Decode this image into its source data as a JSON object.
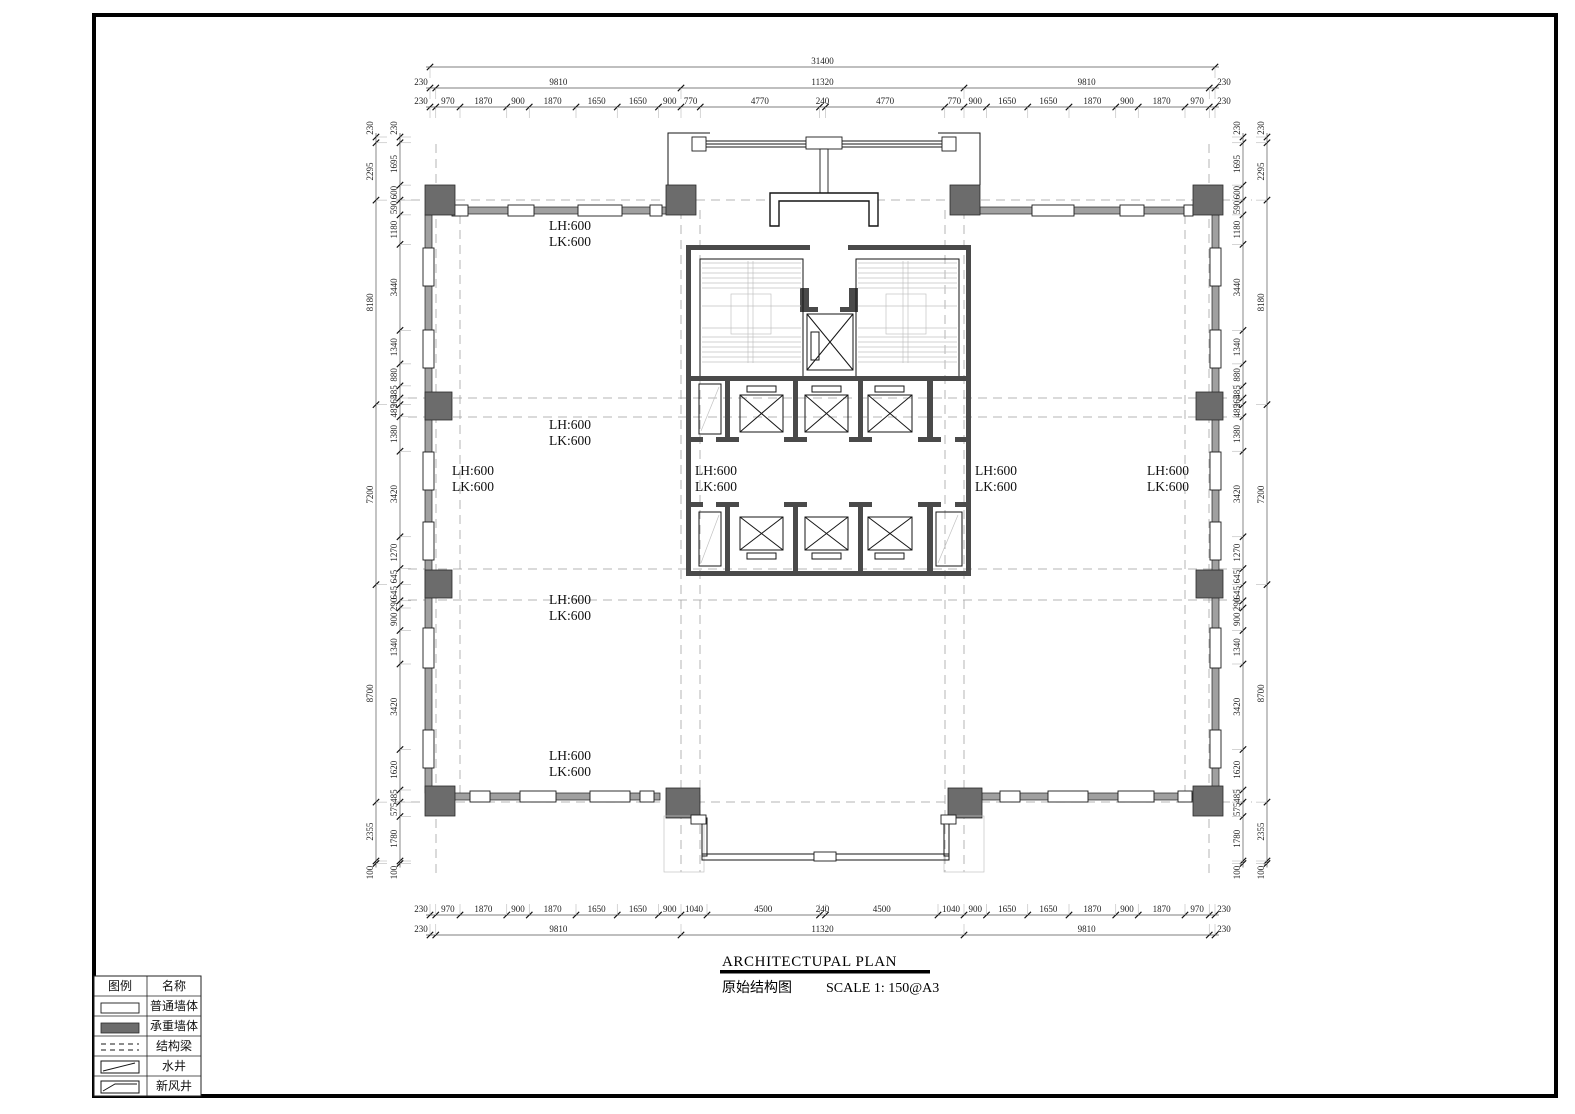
{
  "title_block": {
    "title": "ARCHITECTUPAL PLAN",
    "name": "原始结构图",
    "scale": "SCALE 1: 150@A3"
  },
  "legend": {
    "col_symbol": "图例",
    "col_name": "名称",
    "rows": [
      "普通墙体",
      "承重墙体",
      "结构梁",
      "水井",
      "新风井"
    ]
  },
  "labels": {
    "lh": "LH:600",
    "lk": "LK:600"
  },
  "dimensions": {
    "top_overall": [
      31400
    ],
    "top_major": [
      230,
      9810,
      11320,
      9810,
      230
    ],
    "top_detail": [
      230,
      970,
      1870,
      900,
      1870,
      1650,
      1650,
      900,
      770,
      4770,
      240,
      4770,
      770,
      900,
      1650,
      1650,
      1870,
      900,
      1870,
      970,
      230
    ],
    "bottom_detail": [
      230,
      970,
      1870,
      900,
      1870,
      1650,
      1650,
      900,
      1040,
      4500,
      240,
      4500,
      1040,
      900,
      1650,
      1650,
      1870,
      900,
      1870,
      970,
      230
    ],
    "bottom_major": [
      230,
      9810,
      11320,
      9810,
      230
    ],
    "left_outer": [
      230,
      2295,
      8180,
      7200,
      8700,
      2355,
      100
    ],
    "left_inner": [
      230,
      1695,
      600,
      590,
      1180,
      3440,
      1340,
      880,
      485,
      265,
      485,
      1380,
      3420,
      1270,
      645,
      645,
      290,
      900,
      1340,
      3420,
      1620,
      485,
      575,
      1780,
      100
    ],
    "right_outer": [
      230,
      2295,
      8180,
      7200,
      8700,
      2355,
      100
    ],
    "right_inner": [
      230,
      1695,
      600,
      590,
      1180,
      3440,
      1340,
      880,
      485,
      265,
      485,
      1380,
      3420,
      1270,
      645,
      645,
      290,
      900,
      1340,
      3420,
      1620,
      485,
      575,
      1780,
      100
    ]
  },
  "colors": {
    "wall_fill": "#a0a0a0",
    "column_fill": "#6c6c6c",
    "line": "#1c1c1c"
  }
}
